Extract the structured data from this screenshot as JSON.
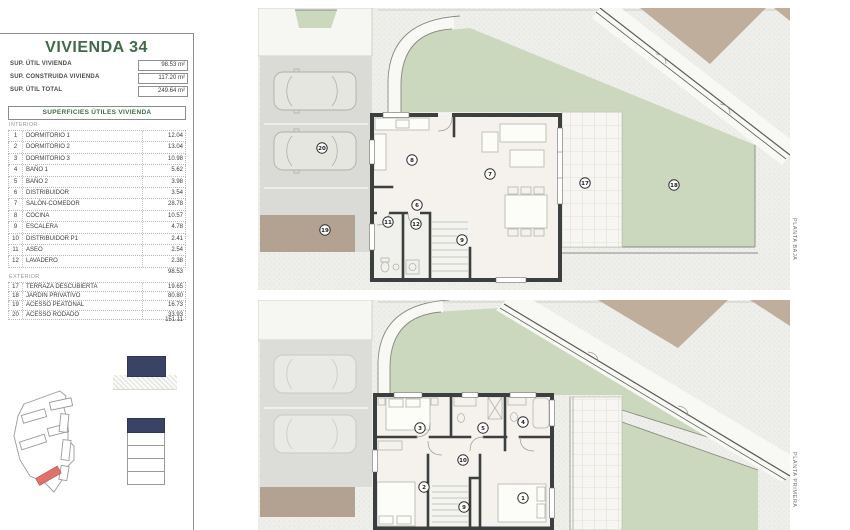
{
  "panel": {
    "title": "VIVIENDA 34",
    "summary": [
      {
        "label": "SUP. ÚTIL VIVIENDA",
        "value": "98.53 m²"
      },
      {
        "label": "SUP. CONSTRUIDA VIVIENDA",
        "value": "117.20 m²"
      },
      {
        "label": "SUP. ÚTIL TOTAL",
        "value": "249.64 m²"
      }
    ],
    "table_header": "SUPERFICIES ÚTILES VIVIENDA",
    "interior_label": "INTERIOR",
    "interior_rows": [
      {
        "num": "1",
        "name": "DORMITORIO 1",
        "value": "12.04"
      },
      {
        "num": "2",
        "name": "DORMITORIO 2",
        "value": "13.04"
      },
      {
        "num": "3",
        "name": "DORMITORIO 3",
        "value": "10.98"
      },
      {
        "num": "4",
        "name": "BAÑO 1",
        "value": "5.62"
      },
      {
        "num": "5",
        "name": "BAÑO 2",
        "value": "3.98"
      },
      {
        "num": "6",
        "name": "DISTRIBUIDOR",
        "value": "3.54"
      },
      {
        "num": "7",
        "name": "SALÓN-COMEDOR",
        "value": "28.78"
      },
      {
        "num": "8",
        "name": "COCINA",
        "value": "10.57"
      },
      {
        "num": "9",
        "name": "ESCALERA",
        "value": "4.78"
      },
      {
        "num": "10",
        "name": "DISTRIBUIDOR P1",
        "value": "2.41"
      },
      {
        "num": "11",
        "name": "ASEO",
        "value": "2.54"
      },
      {
        "num": "12",
        "name": "LAVADERO",
        "value": "2.38"
      }
    ],
    "interior_total": "98.53",
    "exterior_label": "EXTERIOR",
    "exterior_rows": [
      {
        "num": "17",
        "name": "TERRAZA DESCUBIERTA",
        "value": "19.65"
      },
      {
        "num": "18",
        "name": "JARDÍN PRIVATIVO",
        "value": "80.80"
      },
      {
        "num": "19",
        "name": "ACESSO PEATONAL",
        "value": "16.73"
      },
      {
        "num": "20",
        "name": "ACESSO RODADO",
        "value": "33.93"
      }
    ],
    "exterior_total": "151.11"
  },
  "plans": {
    "baja": {
      "label": "PLANTA BAJA",
      "markers": [
        {
          "n": "8",
          "x": 154,
          "y": 152
        },
        {
          "n": "7",
          "x": 232,
          "y": 166
        },
        {
          "n": "6",
          "x": 159,
          "y": 197
        },
        {
          "n": "9",
          "x": 204,
          "y": 232
        },
        {
          "n": "11",
          "x": 130,
          "y": 214
        },
        {
          "n": "12",
          "x": 158,
          "y": 216
        },
        {
          "n": "17",
          "x": 327,
          "y": 175
        },
        {
          "n": "18",
          "x": 416,
          "y": 177
        },
        {
          "n": "19",
          "x": 67,
          "y": 222
        },
        {
          "n": "20",
          "x": 64,
          "y": 140
        }
      ]
    },
    "primera": {
      "label": "PLANTA PRIMERA",
      "markers": [
        {
          "n": "3",
          "x": 162,
          "y": 128
        },
        {
          "n": "5",
          "x": 225,
          "y": 128
        },
        {
          "n": "4",
          "x": 265,
          "y": 122
        },
        {
          "n": "10",
          "x": 205,
          "y": 160
        },
        {
          "n": "2",
          "x": 166,
          "y": 187
        },
        {
          "n": "1",
          "x": 265,
          "y": 198
        },
        {
          "n": "9",
          "x": 206,
          "y": 207
        }
      ]
    }
  },
  "colors": {
    "title_green": "#3e6b47",
    "navy": "#3a4266",
    "plot_red": "#e0726b",
    "lawn": "#ccd8bd",
    "tan": "#b3a291",
    "tan_plots": "#bfae9c",
    "wall": "#3b3f3f",
    "floor": "#f5f2ed"
  }
}
